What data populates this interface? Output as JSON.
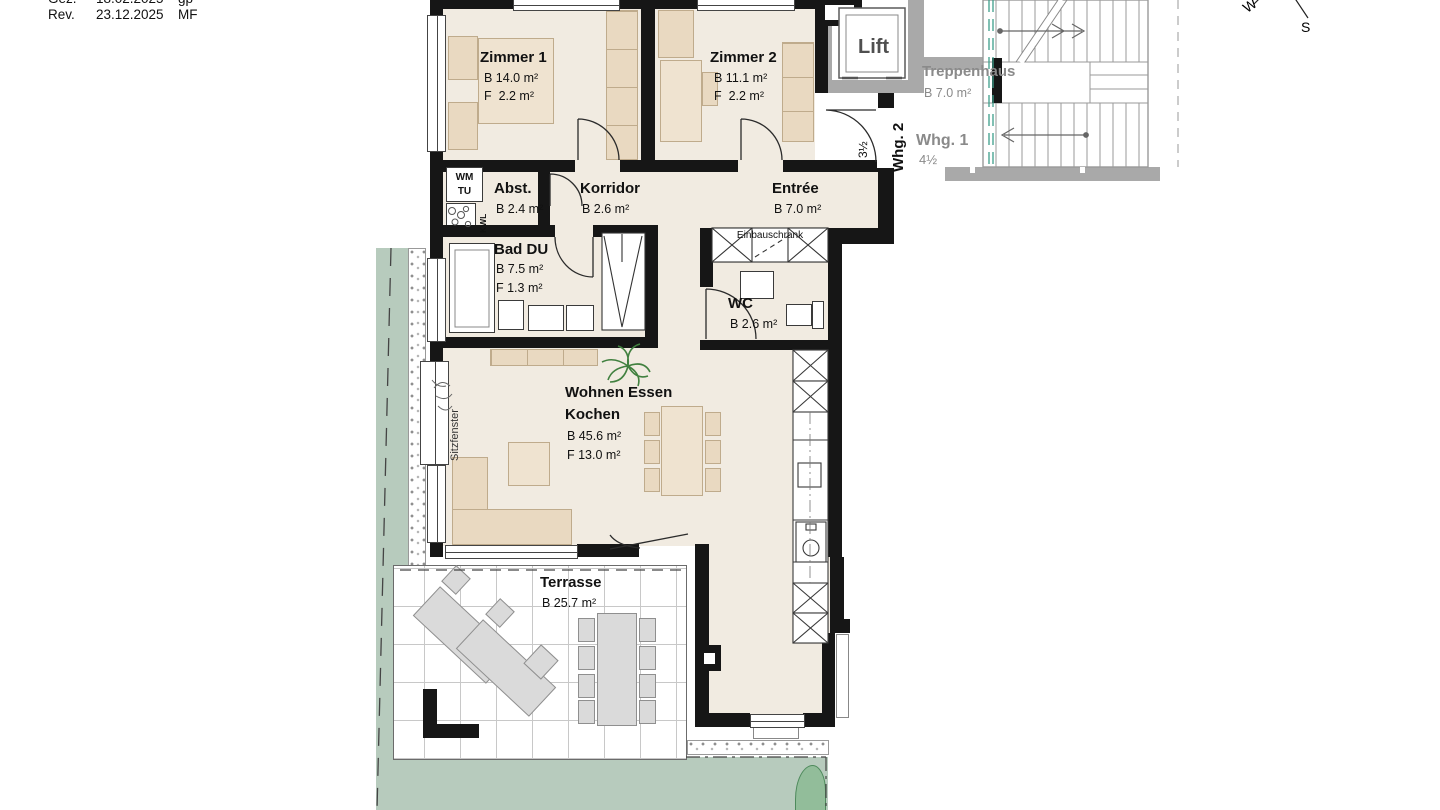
{
  "title_block": {
    "row1": {
      "label": "Gez.",
      "date": "18.02.2025",
      "initials": "gp"
    },
    "row2": {
      "label": "Rev.",
      "date": "23.12.2025",
      "initials": "MF"
    }
  },
  "compass": {
    "west": "W",
    "south": "S"
  },
  "apartment": {
    "zimmer1": {
      "name": "Zimmer 1",
      "area_b": "B 14.0 m²",
      "area_f": "F  2.2 m²"
    },
    "zimmer2": {
      "name": "Zimmer 2",
      "area_b": "B 11.1 m²",
      "area_f": "F  2.2 m²"
    },
    "abstellraum": {
      "name": "Abst.",
      "area_b": "B 2.4 m²"
    },
    "korridor": {
      "name": "Korridor",
      "area_b": "B 2.6 m²"
    },
    "entree": {
      "name": "Entrée",
      "area_b": "B 7.0 m²"
    },
    "bad": {
      "name": "Bad DU",
      "area_b": "B 7.5 m²",
      "area_f": "F 1.3 m²"
    },
    "wc": {
      "name": "WC",
      "area_b": "B 2.6 m²"
    },
    "wohnen": {
      "name_line1": "Wohnen Essen",
      "name_line2": "Kochen",
      "area_b": "B 45.6 m²",
      "area_f": "F 13.0 m²"
    },
    "terrasse": {
      "name": "Terrasse",
      "area_b": "B 25.7 m²"
    },
    "unit": {
      "name": "Whg. 2",
      "rooms": "3½"
    },
    "labels": {
      "einbauschrank": "Einbauschrank",
      "sitzfenster": "Sitzfenster",
      "wm": "WM",
      "tu": "TU",
      "kwl": "KWL"
    }
  },
  "common_areas": {
    "lift": {
      "name": "Lift"
    },
    "treppenhaus": {
      "name": "Treppenhaus",
      "area_b": "B 7.0 m²"
    },
    "whg1": {
      "name": "Whg. 1",
      "rooms": "4½"
    }
  },
  "colors": {
    "wall": "#161616",
    "floor": "#f1ebe1",
    "furn": "#e9d9c1",
    "furn_border": "#bfab8c",
    "lawn": "#b7cbbd",
    "bush": "#92bd9a",
    "gray_wall": "#a9a9a9",
    "muted_text": "#8a8a8a",
    "terrace_furn": "#dadada",
    "section_line_teal": "#3d9e8a",
    "plant_green": "#4a7d4f"
  }
}
